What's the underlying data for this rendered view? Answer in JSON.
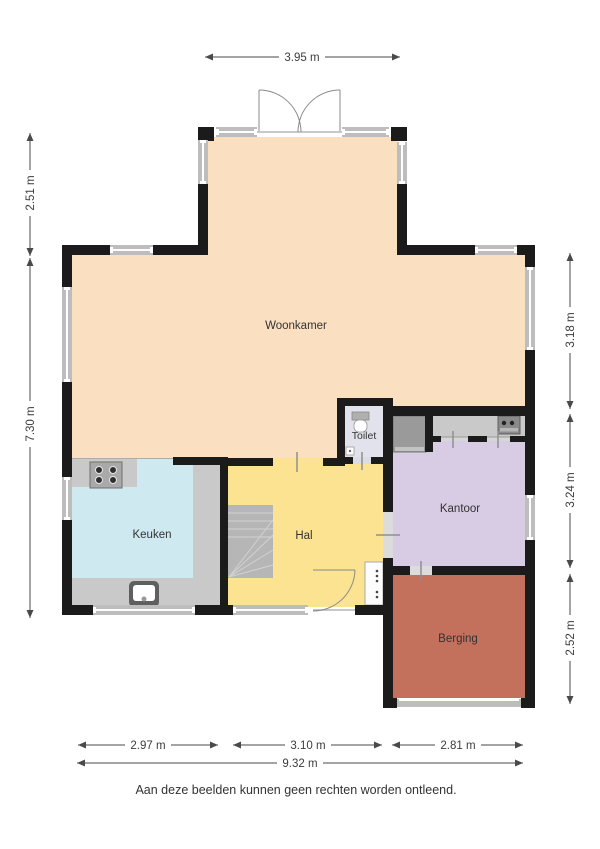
{
  "disclaimer": "Aan deze beelden kunnen geen rechten worden ontleend.",
  "rooms": {
    "woonkamer": {
      "label": "Woonkamer"
    },
    "keuken": {
      "label": "Keuken"
    },
    "hal": {
      "label": "Hal"
    },
    "toilet": {
      "label": "Toilet"
    },
    "kantoor": {
      "label": "Kantoor"
    },
    "berging": {
      "label": "Berging"
    }
  },
  "dimensions": {
    "top_width": "3.95 m",
    "left_upper": "2.51 m",
    "left_lower": "7.30 m",
    "right_upper": "3.18 m",
    "right_middle": "3.24 m",
    "right_lower": "2.52 m",
    "bottom_keuken": "2.97 m",
    "bottom_hal": "3.10 m",
    "bottom_berging": "2.81 m",
    "bottom_total": "9.32 m"
  },
  "colors": {
    "woonkamer": "#fbdfc1",
    "keuken": "#cfe9f1",
    "hal": "#fbe392",
    "toilet": "#e2e2ec",
    "kantoor": "#d7cce3",
    "berging": "#c3705d",
    "wall": "#1b1b1b",
    "window": "#bdbdbd",
    "counter": "#c9c9c9",
    "nook_floor": "#d6d6d6",
    "stairs": "#b6b6b6"
  }
}
